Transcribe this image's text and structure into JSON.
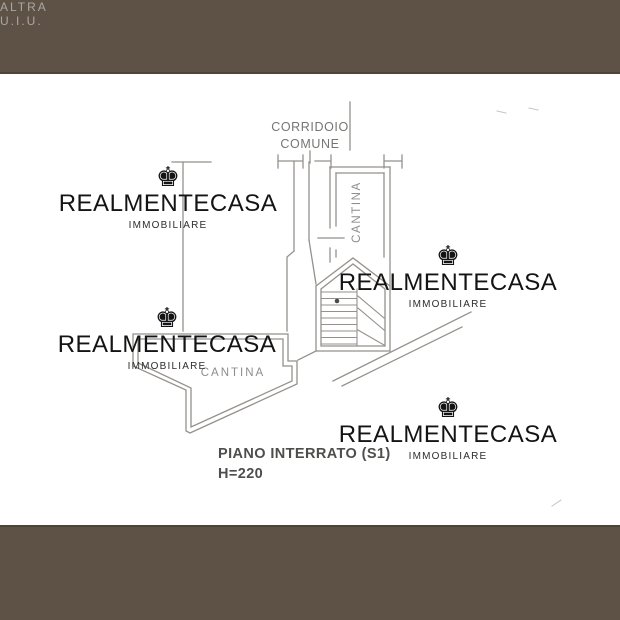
{
  "image": {
    "width": 620,
    "height": 620
  },
  "frame": {
    "bar_color": "#5e5246",
    "bar_edge_color": "#4c4338",
    "background": "#ffffff"
  },
  "watermark": {
    "icon": "crown-icon",
    "icon_glyph": "♚",
    "title": "REALMENTECASA",
    "subtitle": "IMMOBILIARE",
    "text_color": "#141414"
  },
  "plan": {
    "line_color": "#95918c",
    "label_color": "#8d8d8a",
    "title_color": "#4e4e4c",
    "labels": {
      "corridor_line1": "CORRIDOIO",
      "corridor_line2": "COMUNE",
      "cantina_right": "CANTINA",
      "cantina_left": "CANTINA",
      "adjacent_unit": "ALTRA U.I.U.",
      "floor_title": "PIANO INTERRATO (S1)",
      "floor_height": "H=220"
    }
  }
}
